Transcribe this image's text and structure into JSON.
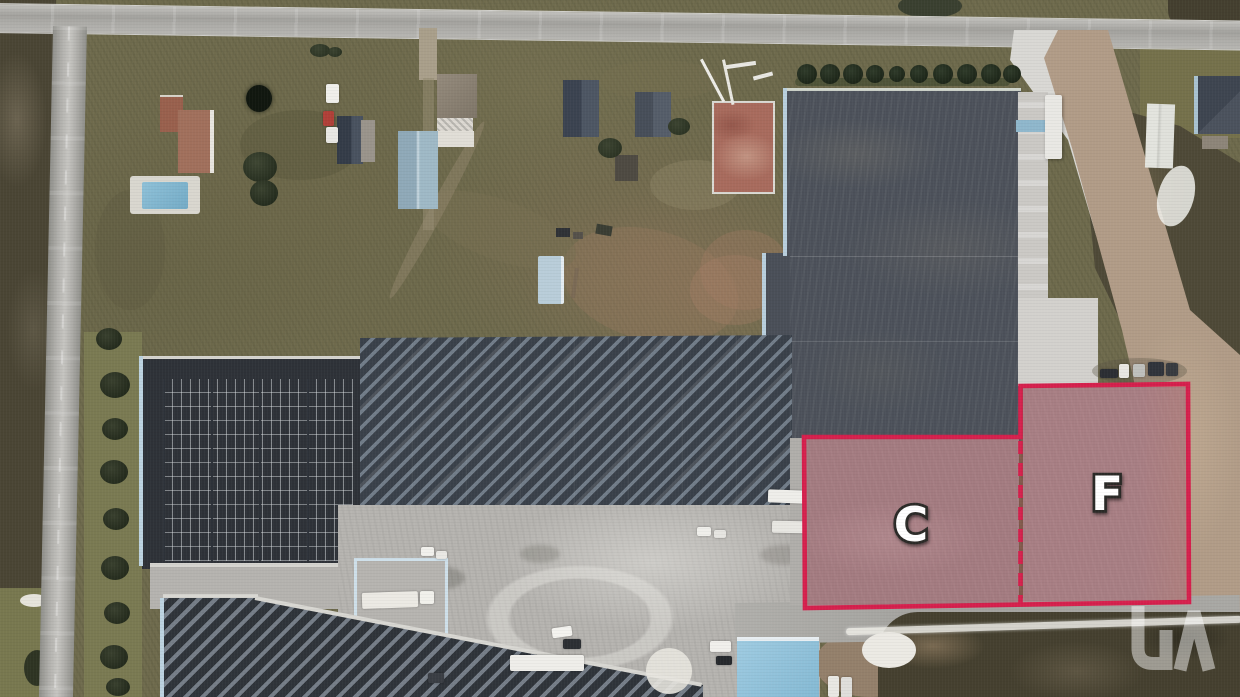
{
  "scene": {
    "description": "aerial-photo-of-industrial-property-with-highlighted-availability-zones",
    "zones": [
      {
        "id": "C",
        "label": "C"
      },
      {
        "id": "F",
        "label": "F"
      }
    ],
    "colors": {
      "outline-red": "#d6204d",
      "zone-fill": "rgba(206,36,76,0.22)",
      "label-fill": "#ffffff",
      "label-stroke": "#2b2a27",
      "watermark-white": "rgba(255,255,255,0.48)"
    },
    "watermark_icon": "brand-watermark-logo"
  }
}
